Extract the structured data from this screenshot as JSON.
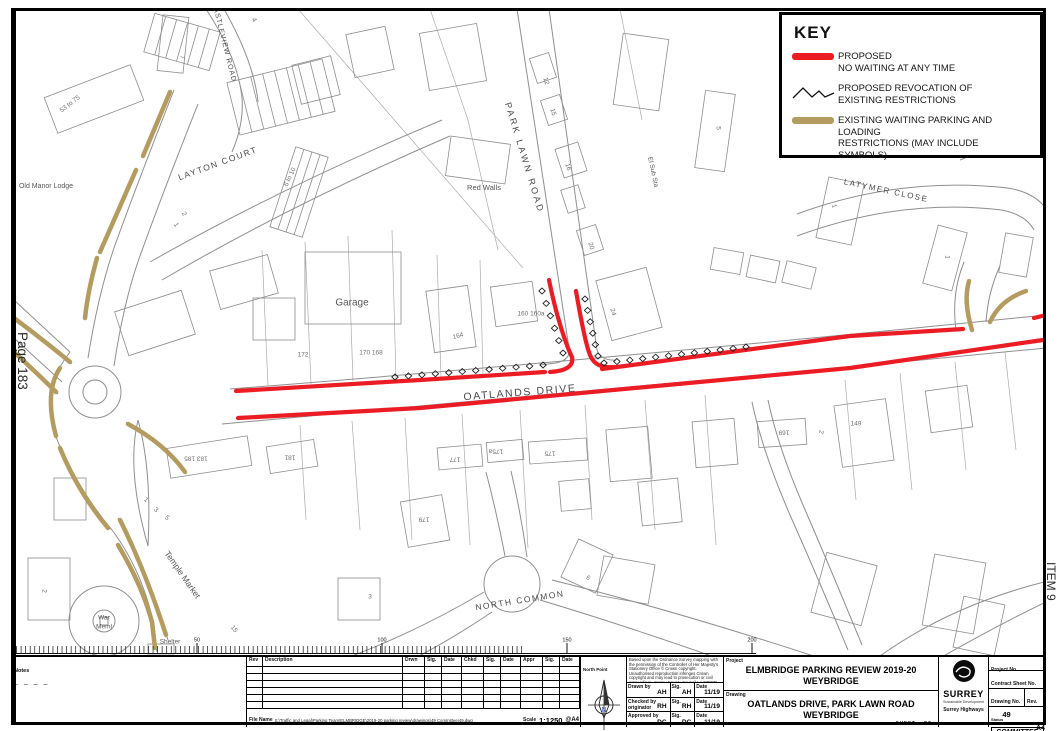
{
  "colors": {
    "proposed": "#ec1c24",
    "existing": "#b49b5f",
    "map_line": "#8f8f8f",
    "north_letter": "#2b50c8"
  },
  "margins": {
    "page_number": "Page 183",
    "item": "ITEM 9"
  },
  "key": {
    "title": "KEY",
    "entries": [
      {
        "symbol": "proposed-line",
        "line1": "PROPOSED",
        "line2": "NO WAITING AT ANY TIME"
      },
      {
        "symbol": "revocation-zigzag",
        "line1": "PROPOSED REVOCATION OF",
        "line2": "EXISTING RESTRICTIONS"
      },
      {
        "symbol": "existing-line",
        "line1": "EXISTING WAITING PARKING AND LOADING",
        "line2": "RESTRICTIONS (MAY INCLUDE SYMBOLS)"
      }
    ]
  },
  "map": {
    "street_labels": [
      {
        "text": "OATLANDS DRIVE",
        "x": 520,
        "y": 393,
        "rot": -4.5,
        "size": 10.5,
        "ls": 1.6
      },
      {
        "text": "PARK LAWN ROAD",
        "x": 524,
        "y": 158,
        "rot": 73,
        "size": 9,
        "ls": 2.5
      },
      {
        "text": "LAYTON COURT",
        "x": 218,
        "y": 164,
        "rot": -20,
        "size": 8.5,
        "ls": 1.5
      },
      {
        "text": "CASTLEVIEW ROAD",
        "x": 224,
        "y": 42,
        "rot": 76,
        "size": 7,
        "ls": 1
      },
      {
        "text": "LATYMER CLOSE",
        "x": 886,
        "y": 191,
        "rot": 12,
        "size": 8,
        "ls": 1.5
      },
      {
        "text": "NORTH COMMON",
        "x": 520,
        "y": 601,
        "rot": -9,
        "size": 8.5,
        "ls": 1.5
      }
    ],
    "place_labels": [
      {
        "text": "Old Manor Lodge",
        "x": 46,
        "y": 186,
        "rot": 0,
        "size": 7
      },
      {
        "text": "Garage",
        "x": 352,
        "y": 303,
        "rot": 0,
        "size": 10
      },
      {
        "text": "Red Walls",
        "x": 484,
        "y": 188,
        "rot": 0,
        "size": 7.5
      },
      {
        "text": "El Sub Sta",
        "x": 653,
        "y": 172,
        "rot": 78,
        "size": 6.5
      },
      {
        "text": "Temple Market",
        "x": 182,
        "y": 575,
        "rot": 55,
        "size": 8.5
      },
      {
        "text": "War",
        "x": 104,
        "y": 618,
        "rot": 0,
        "size": 6.5
      },
      {
        "text": "Meml",
        "x": 104,
        "y": 627,
        "rot": 0,
        "size": 6.5
      },
      {
        "text": "Shelter",
        "x": 170,
        "y": 642,
        "rot": 0,
        "size": 6.5
      }
    ],
    "house_numbers": [
      {
        "text": "4",
        "x": 254,
        "y": 20,
        "rot": 60
      },
      {
        "text": "7",
        "x": 182,
        "y": 57,
        "rot": 90
      },
      {
        "text": "53 to 75",
        "x": 70,
        "y": 104,
        "rot": -38
      },
      {
        "text": "6 to 10",
        "x": 290,
        "y": 177,
        "rot": -65
      },
      {
        "text": "2",
        "x": 184,
        "y": 214,
        "rot": 60
      },
      {
        "text": "1",
        "x": 176,
        "y": 225,
        "rot": 60
      },
      {
        "text": "12",
        "x": 546,
        "y": 81,
        "rot": 72
      },
      {
        "text": "15",
        "x": 553,
        "y": 112,
        "rot": 72
      },
      {
        "text": "16",
        "x": 568,
        "y": 167,
        "rot": 72
      },
      {
        "text": "20",
        "x": 591,
        "y": 246,
        "rot": 72
      },
      {
        "text": "24",
        "x": 613,
        "y": 312,
        "rot": 75
      },
      {
        "text": "5",
        "x": 718,
        "y": 128,
        "rot": 90
      },
      {
        "text": "1",
        "x": 834,
        "y": 206,
        "rot": 75
      },
      {
        "text": "1",
        "x": 947,
        "y": 257,
        "rot": 90
      },
      {
        "text": "172",
        "x": 303,
        "y": 355,
        "rot": 0
      },
      {
        "text": "170 168",
        "x": 371,
        "y": 353,
        "rot": 0
      },
      {
        "text": "164",
        "x": 458,
        "y": 336,
        "rot": -15
      },
      {
        "text": "160 160a",
        "x": 531,
        "y": 314,
        "rot": 0
      },
      {
        "text": "183 185",
        "x": 196,
        "y": 458,
        "rot": 180
      },
      {
        "text": "181",
        "x": 290,
        "y": 457,
        "rot": 180
      },
      {
        "text": "1",
        "x": 146,
        "y": 500,
        "rot": 40
      },
      {
        "text": "3",
        "x": 156,
        "y": 510,
        "rot": 40
      },
      {
        "text": "5",
        "x": 167,
        "y": 518,
        "rot": 40
      },
      {
        "text": "15",
        "x": 234,
        "y": 629,
        "rot": 50
      },
      {
        "text": "177",
        "x": 455,
        "y": 459,
        "rot": 180
      },
      {
        "text": "175a",
        "x": 496,
        "y": 451,
        "rot": 180
      },
      {
        "text": "175",
        "x": 550,
        "y": 453,
        "rot": 180
      },
      {
        "text": "179",
        "x": 424,
        "y": 519,
        "rot": 180
      },
      {
        "text": "169",
        "x": 784,
        "y": 432,
        "rot": 180
      },
      {
        "text": "2",
        "x": 821,
        "y": 432,
        "rot": 100
      },
      {
        "text": "149",
        "x": 856,
        "y": 424,
        "rot": 0
      },
      {
        "text": "6",
        "x": 588,
        "y": 578,
        "rot": 30
      },
      {
        "text": "3",
        "x": 370,
        "y": 597,
        "rot": 0
      },
      {
        "text": "2",
        "x": 44,
        "y": 591,
        "rot": 90
      }
    ]
  },
  "scale_bar": {
    "stations": [
      {
        "label": "0",
        "x": 14
      },
      {
        "label": "50",
        "x": 197
      },
      {
        "label": "100",
        "x": 382
      },
      {
        "label": "150",
        "x": 567
      },
      {
        "label": "200",
        "x": 752
      }
    ]
  },
  "title_block": {
    "notes_label": "Notes",
    "notes_dashes": "– – – –",
    "revision_headers": [
      "Rev",
      "Description",
      "Drwn",
      "Sig.",
      "Date",
      "Chkd",
      "Sig.",
      "Date",
      "Appr",
      "Sig.",
      "Date"
    ],
    "file_name_label": "File Name",
    "file_name": "S:\\Traffic and Legal\\Parking Team\\ELMBRIDGE\\2019-20 parking review\\drawings\\49 Committee\\49.dwg",
    "scale_label": "Scale",
    "scale": "1:1250",
    "at_size": "@A4",
    "north_point_label": "North Point",
    "north_letter": "N",
    "copyright": "Based upon the Ordnance Survey mapping with the permission of the Controller of Her Majesty's Stationery Office © Crown copyright. Unauthorised reproduction infringes Crown copyright and may lead to prosecution or civil proceedings. Surrey County Council LA 076872 2019.",
    "sig_label": "Sig.",
    "date_label": "Date",
    "signatures": [
      {
        "role": "Drawn by",
        "name": "AH",
        "sig": "AH",
        "date": "11/19"
      },
      {
        "role": "Checked by originator",
        "name": "RH",
        "sig": "RH",
        "date": "11/19"
      },
      {
        "role": "Approved by",
        "name": "DC",
        "sig": "DC",
        "date": "11/19"
      }
    ],
    "project_label": "Project",
    "project_line1": "ELMBRIDGE PARKING REVIEW 2019-20",
    "project_line2": "WEYBRIDGE",
    "drawing_label": "Drawing",
    "drawing_line1": "OATLANDS DRIVE, PARK LAWN ROAD",
    "drawing_line2": "WEYBRIDGE",
    "sheet_label": "SHEET",
    "of_label": "OF",
    "logo_name": "SURREY",
    "logo_sub1": "Sustainable Development",
    "logo_sub2": "Surrey Highways",
    "project_no_label": "Project No.",
    "contract_label": "Contract Sheet No.",
    "drawing_no_label": "Drawing No.",
    "drawing_no": "49",
    "rev_label": "Rev.",
    "status_label": "Status",
    "status": "COMMITTEE",
    "paper": "A4"
  }
}
